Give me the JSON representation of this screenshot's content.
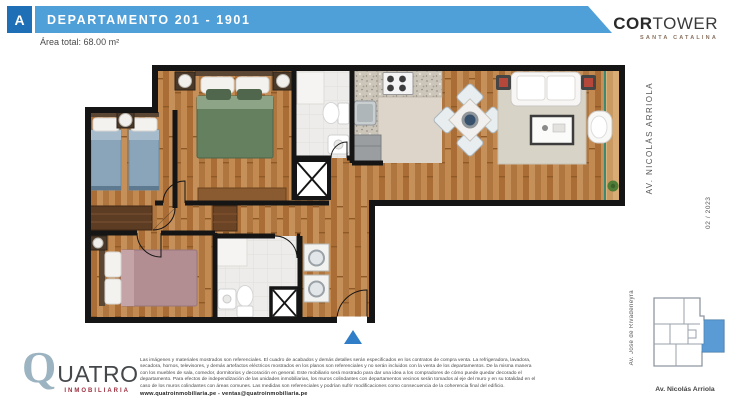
{
  "header": {
    "unit_letter": "A",
    "title": "DEPARTAMENTO 201 - 1901",
    "area_label": "Área total:",
    "area_value": "68.00 m²"
  },
  "brand": {
    "name_bold": "COR",
    "name_light": "TOWER",
    "subtitle": "SANTA CATALINA"
  },
  "margin": {
    "street_right": "AV. NICOLÁS ARRIOLA",
    "date": "02 / 2023"
  },
  "key_map": {
    "street_left": "Av. José de Rivadeneyra",
    "street_bottom": "Av. Nicolás Arriola",
    "highlight_color": "#5b9bd5"
  },
  "floor_plan": {
    "entrance_marker": "entrance-triangle",
    "marker_color": "#2f7ec7",
    "rooms": [
      "dormitorio principal",
      "dormitorio 2",
      "dormitorio 3",
      "baño 1",
      "baño 2",
      "cocina",
      "comedor",
      "sala",
      "balcón",
      "lavandería"
    ]
  },
  "footer": {
    "logo_q": "Q",
    "logo_rest": "UATRO",
    "logo_tagline": "INMOBILIARIA",
    "disclaimer": "Las imágenes y materiales mostrados son referenciales. El cuadro de acabados y demás detalles serán especificados en los contratos de compra venta. La refrigeradora, lavadora, secadora, hornos, televisores, y demás artefactos eléctricos mostrados en los planos son referenciales y no serán incluidos con la venta de los departamentos. De la misma manera con los muebles de sala, comedor, dormitorios y decoración en general. Este mobiliario será mostrado para dar una idea a los compradores de cómo puede quedar decorado el departamento. Para efectos de independización de las unidades inmobiliarias, los muros colindantes con departamentos vecinos serán tomados al eje del muro y en su totalidad en el caso de los muros colindantes con áreas comunes. Las medidas son referenciales y podrían sufrir modificaciones como consecuencia de la coherencia final del edificio.",
    "contact": "www.quatroinmobiliaria.pe - ventas@quatroinmobiliaria.pe"
  },
  "colors": {
    "header_bar": "#4f9fd8",
    "unit_box": "#1e6fb5",
    "logo_q": "#9cb4c1",
    "logo_tagline": "#9c2f3f",
    "walls": "#151515",
    "wood_floor": "#b87a42",
    "map_highlight": "#5b9bd5"
  }
}
